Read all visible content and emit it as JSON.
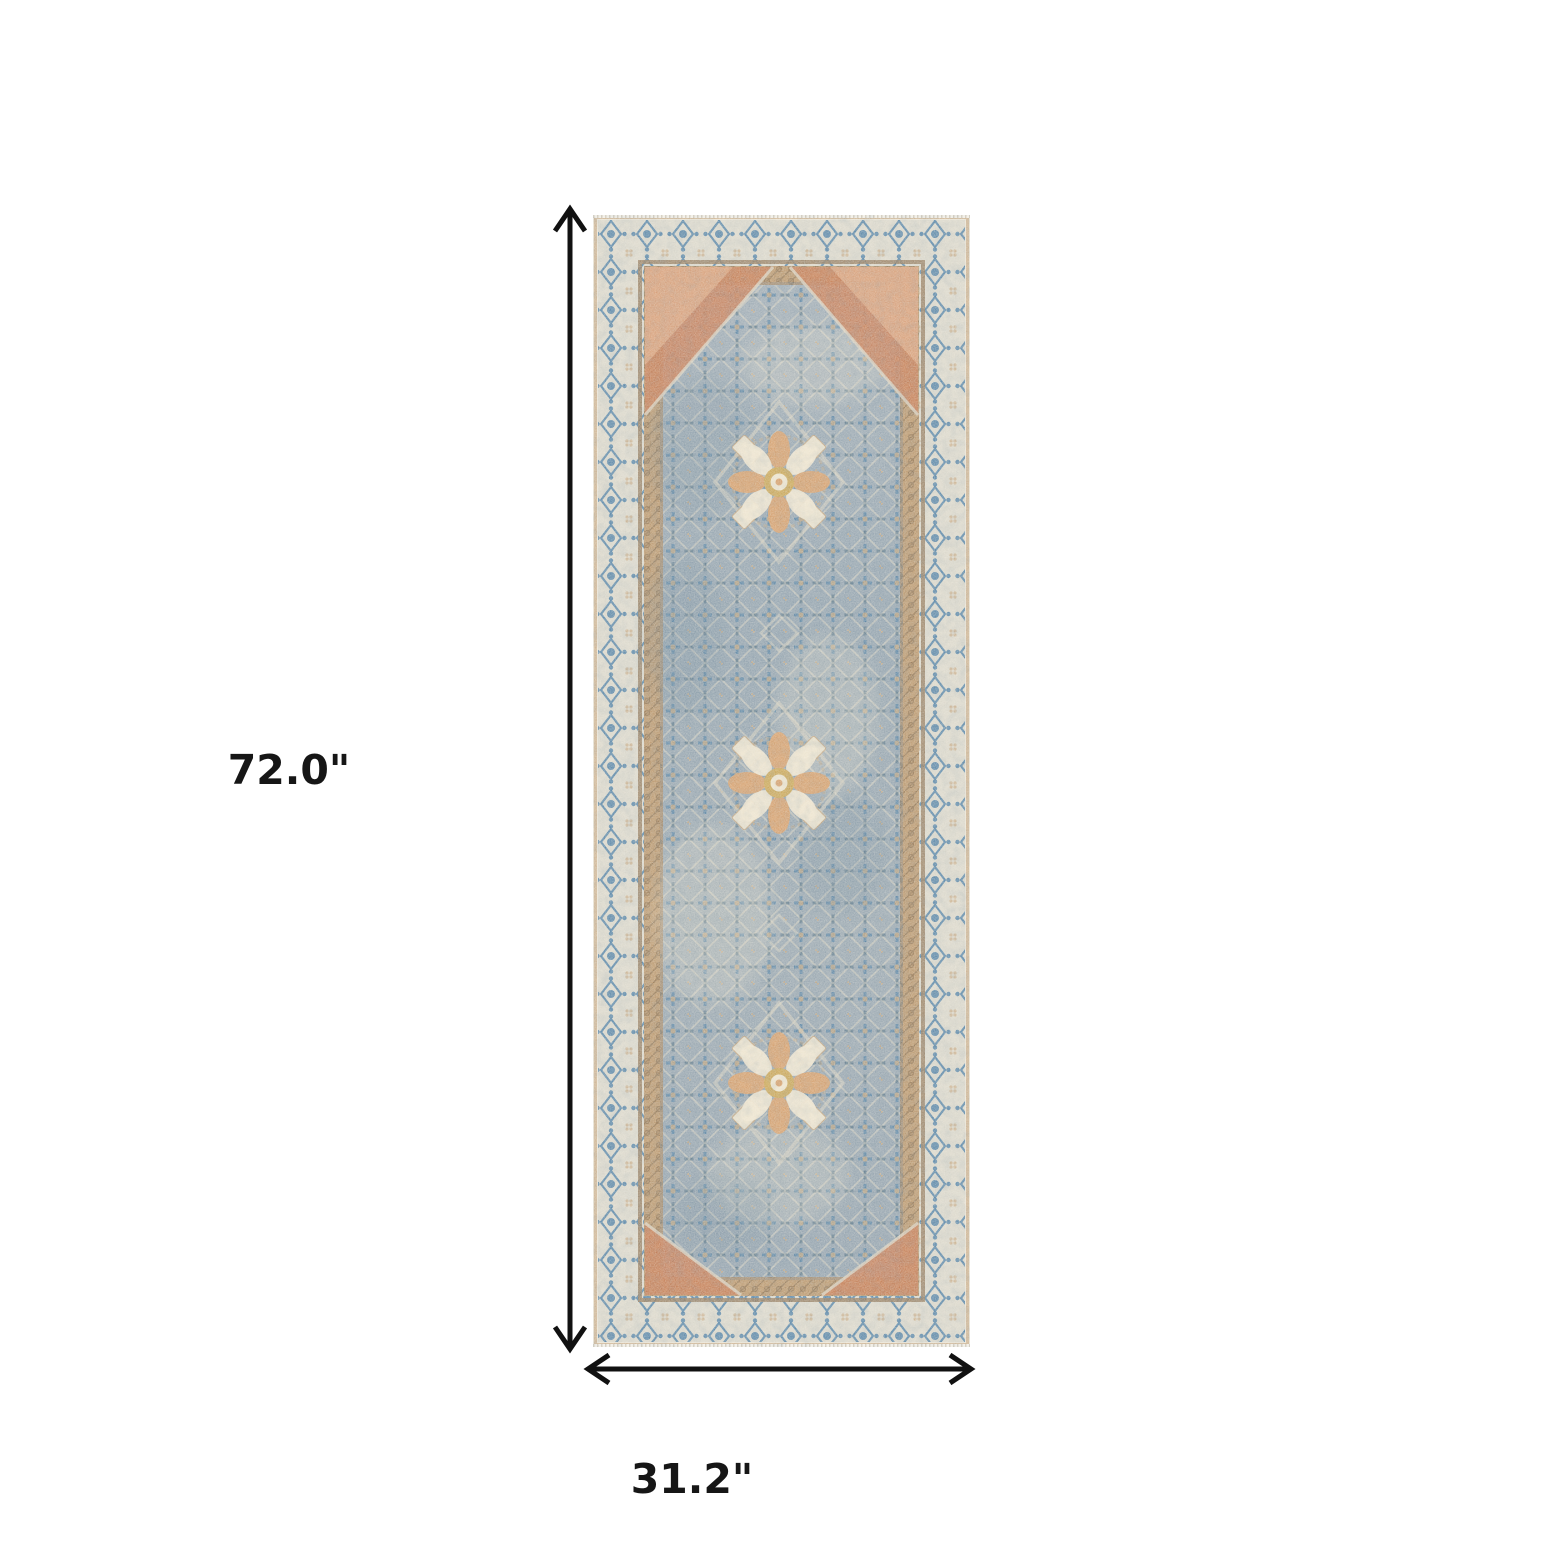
{
  "scene": {
    "type": "product-dimension-image",
    "subject": "vintage-persian-style-runner-rug",
    "medallion_count": 3
  },
  "dimensions": {
    "height_label": "72.0\"",
    "width_label": "31.2\""
  },
  "theme": {
    "page-bg": "#ffffff",
    "arrow": "#111111",
    "label": "#161616",
    "edge-cream": "#e9e3d6",
    "border-cream": "#d9d6ca",
    "border-blue": "#4579a2",
    "guard-brown": "#8d7355",
    "chain-tan": "#b69267",
    "chain-dark": "#8a6b49",
    "field-light": "#9dabb6",
    "field-base": "#90a1af",
    "field-deep": "#5f7d92",
    "motif-blue": "#4c7ba0",
    "motif-dark": "#3c5f77",
    "motif-cream": "#d8d1bf",
    "motif-tan": "#c2a27a",
    "spandrel-orange": "#c4754c",
    "spandrel-light": "#daa27c",
    "medallion-orange": "#d59a63",
    "medallion-cream": "#ece3cd",
    "medallion-gold": "#c7a24f"
  }
}
